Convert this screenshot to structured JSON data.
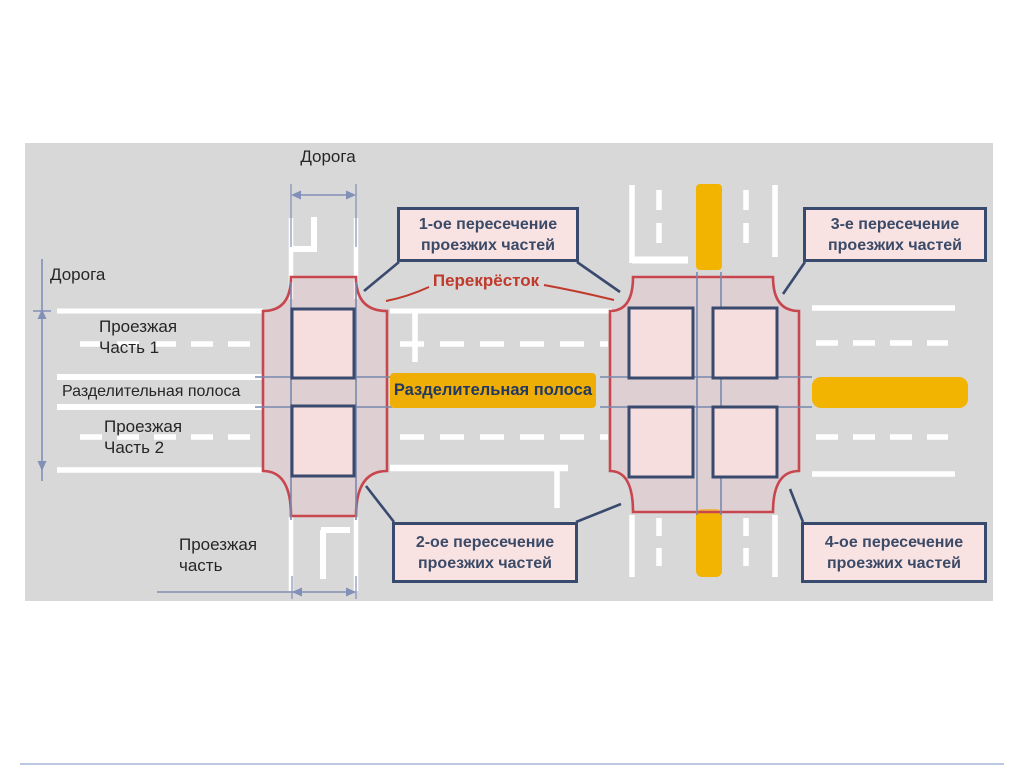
{
  "diagram": {
    "labels": {
      "road_top": "Дорога",
      "road_left": "Дорога",
      "carriageway1": "Проезжая Часть 1",
      "median_left": "Разделительная полоса",
      "carriageway2": "Проезжая Часть 2",
      "intersection": "Перекрёсток",
      "median_center": "Разделительная полоса",
      "carriageway_bottom": "Проезжая часть"
    },
    "callouts": {
      "c1": "1-ое пересечение проезжих частей",
      "c2": "2-ое пересечение проезжих частей",
      "c3": "3-е пересечение проезжих частей",
      "c4": "4-ое пересечение проезжих частей"
    },
    "colors": {
      "panel_background": "#d8d8d8",
      "road_marking": "#ffffff",
      "median_bar": "#f3b301",
      "median_label_bar": "#efae06",
      "intersection_outline": "#c8464e",
      "crossing_fill": "#f7dede",
      "crossing_border": "#3a4a6e",
      "callout_fill": "#f8e2e2",
      "callout_border": "#384a6e",
      "callout_text": "#3b4a67",
      "label_text": "#262626",
      "intersection_label_text": "#c0392b",
      "dimension_lines": "#8290b8",
      "guide_lines": "#7787ae"
    }
  }
}
